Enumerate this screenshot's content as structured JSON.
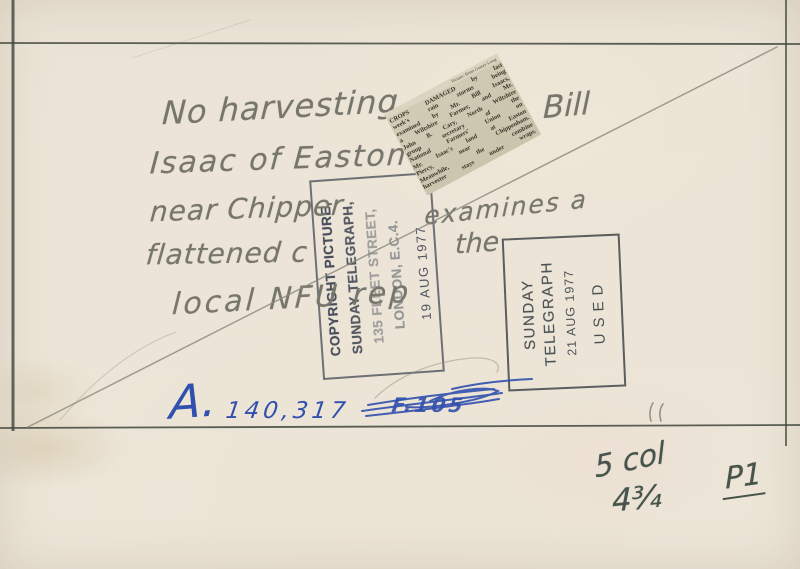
{
  "document_type": "press-photo-verso",
  "colors": {
    "paper": "#ebe4d6",
    "frame_line": "#41453b",
    "pencil": "#77766c",
    "stamp_ink": "#3a4150",
    "pen_blue": "#3150ae",
    "newsprint": "#cdc7b1",
    "grease_pencil": "#46544b"
  },
  "handwriting": {
    "line1a": "No harvesting",
    "line1b": "Bill",
    "line2": "Isaac of Easton",
    "line3a": "near Chipper",
    "line3b": "examines a",
    "line4a": "flattened c",
    "line4b": "the",
    "line5": "local NFU rep",
    "ref_letter": "A.",
    "ref_number": "140,317",
    "crossed_out_code": "F.105",
    "col_size": "5 col",
    "width_size": "4¾",
    "page_mark": "P1"
  },
  "clipping": {
    "credit": "Picture: Brian Gentry-Long",
    "lines": [
      "CROPS DAMAGED by last",
      "week's rain storms being",
      "examined by Mr. Bill Isaacs,",
      "a Wiltshire Farmer, and Mr.",
      "John B. Cary, North Wiltshire",
      "group secretary of the",
      "National Farmers' Union on",
      "Mr. Isaac's land at Easton",
      "Piercy, near Chippenham.",
      "Meanwhile, the combine",
      "harvester stays under wraps."
    ]
  },
  "stamps": {
    "copyright": {
      "line1": "COPYRIGHT PICTURE,",
      "line2": "SUNDAY TELEGRAPH,",
      "line3": "135 FLEET STREET,",
      "line4": "LONDON, E.C.4.",
      "date": "19 AUG 1977"
    },
    "used": {
      "line1": "SUNDAY",
      "line2": "TELEGRAPH",
      "date": "21 AUG 1977",
      "status": "USED"
    }
  }
}
